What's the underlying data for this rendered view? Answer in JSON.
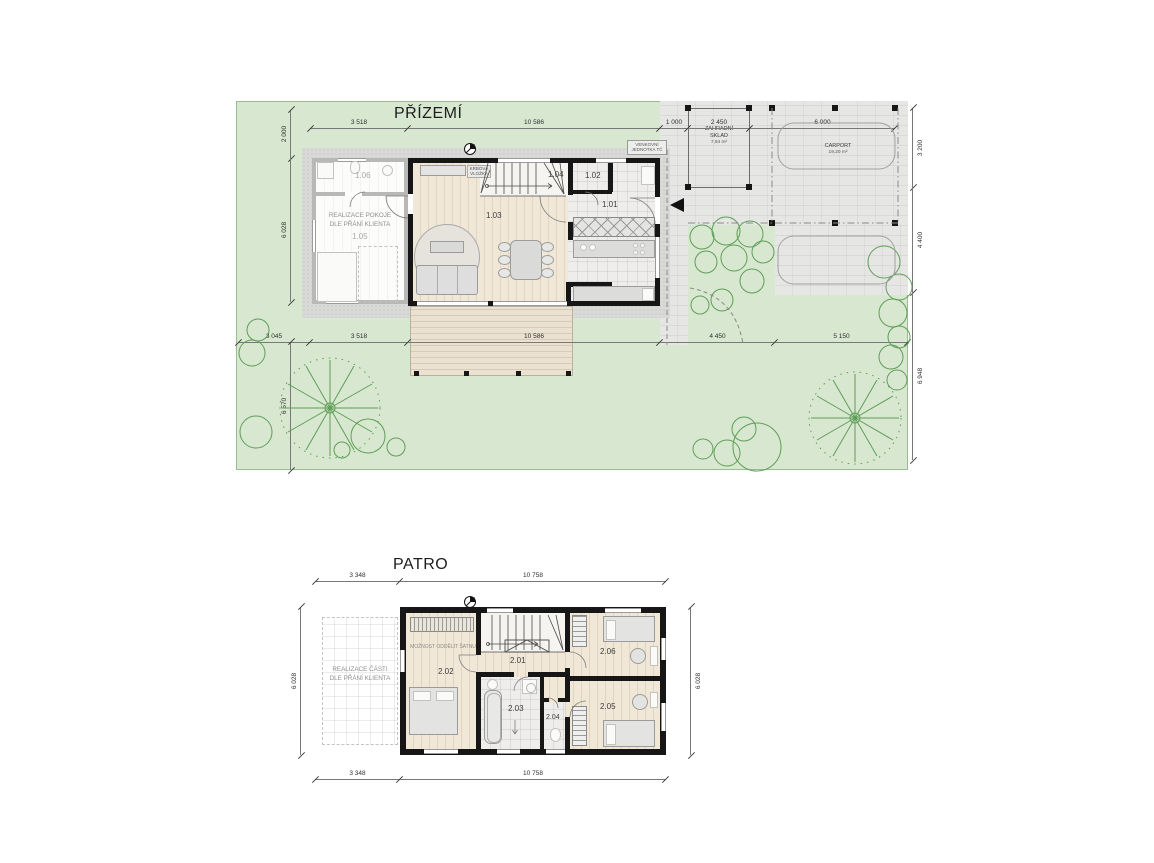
{
  "prizemi": {
    "title": "PŘÍZEMÍ",
    "rooms": {
      "r101": "1.01",
      "r102": "1.02",
      "r103": "1.03",
      "r104": "1.04",
      "r105": "1.05",
      "r106": "1.06"
    },
    "notes": {
      "realizace": "REALIZACE POKOJE\nDLE PŘÁNÍ KLIENTA",
      "krbova": "KRBOVÁ\nVLOŽKA",
      "venkovni": "VENKOVNÍ\nJEDNOTKA TČ"
    },
    "sklad": {
      "name": "ZAHRADNÍ\nSKLAD",
      "area": "7,84 m²"
    },
    "carport": {
      "name": "CARPORT",
      "area": "19,20 m²"
    },
    "dims": {
      "top": [
        "3 518",
        "10 586",
        "1 000",
        "2 450",
        "6 000"
      ],
      "bottom": [
        "3 045",
        "3 518",
        "10 586",
        "4 450",
        "5 150"
      ],
      "left": [
        "2 000",
        "6 028",
        "6 570"
      ],
      "right": [
        "3 200",
        "4 400",
        "6 948"
      ]
    }
  },
  "patro": {
    "title": "PATRO",
    "rooms": {
      "r201": "2.01",
      "r202": "2.02",
      "r203": "2.03",
      "r204": "2.04",
      "r205": "2.05",
      "r206": "2.06"
    },
    "notes": {
      "realizace": "REALIZACE ČÁSTI\nDLE PŘÁNÍ KLIENTA",
      "satna": "MOŽNOST ODDĚLIT ŠATNU"
    },
    "dims": {
      "top": [
        "3 348",
        "10 758"
      ],
      "bottom": [
        "3 348",
        "10 758"
      ],
      "left": "6 028",
      "right": "6 028"
    }
  }
}
